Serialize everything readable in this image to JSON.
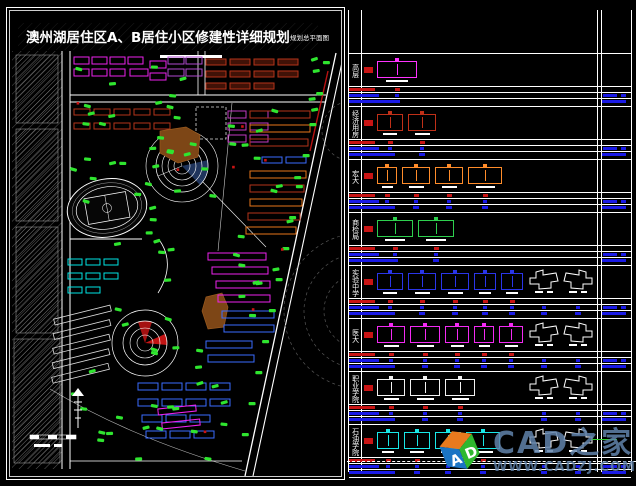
{
  "title": {
    "main": "澳州湖居住区A、B居住小区修建性详细规划",
    "sub": "规划总平面图"
  },
  "map": {
    "colors": {
      "background": "#000000",
      "road": "#ffffff",
      "hatch": "#7a7a7a",
      "tree": "#2fe52f",
      "red_accent": "#cc1414",
      "dark_red_building": "#b3331a",
      "magenta_building": "#ee22ee",
      "orange_building": "#e8761a",
      "blue_building": "#3a6cff",
      "cyan_building": "#00e5e5",
      "brown_block": "#7d4616"
    },
    "features": [
      "stadium-track",
      "upper-circular-plaza",
      "lower-circular-plaza",
      "diagonal-boundary-road",
      "contour-lines",
      "scale-bar",
      "survey-staff"
    ]
  },
  "legend_panel": {
    "bar_colors": {
      "red": "#c81414",
      "blue": "#1a1ae6"
    },
    "rows": [
      {
        "label": "高层",
        "color": "#ff33ff",
        "buildings": [
          40
        ],
        "white_buildings": 0,
        "green_line": false
      },
      {
        "label": "经济用房",
        "color": "#c03018",
        "buildings": [
          26,
          28
        ],
        "white_buildings": 0,
        "green_line": false
      },
      {
        "label": "宏大",
        "color": "#ff8c2a",
        "buildings": [
          20,
          28,
          28,
          34
        ],
        "white_buildings": 0,
        "green_line": false
      },
      {
        "label": "商检局",
        "color": "#2ed04e",
        "buildings": [
          36,
          36
        ],
        "white_buildings": 0,
        "green_line": false
      },
      {
        "label": "实验中学",
        "color": "#2a35e8",
        "buildings": [
          26,
          28,
          28,
          22,
          22
        ],
        "white_buildings": 2,
        "green_line": false
      },
      {
        "label": "医大",
        "color": "#f32af3",
        "buildings": [
          28,
          30,
          24,
          20,
          24
        ],
        "white_buildings": 2,
        "green_line": false
      },
      {
        "label": "职业学院",
        "color": "#f2f2f2",
        "buildings": [
          28,
          30,
          30
        ],
        "white_buildings": 2,
        "green_line": false
      },
      {
        "label": "石油学院",
        "color": "#19e8e8",
        "buildings": [
          22,
          26,
          26,
          34
        ],
        "white_buildings": 2,
        "green_line": true
      }
    ]
  },
  "watermark": {
    "brand": "CAD之家",
    "url": "WWW.CADZJ.COM",
    "cube_letters": {
      "front": "A",
      "side": "D"
    },
    "cube_colors": {
      "top": "#e87a1e",
      "front": "#1b74c4",
      "side": "#2eb82e"
    }
  }
}
